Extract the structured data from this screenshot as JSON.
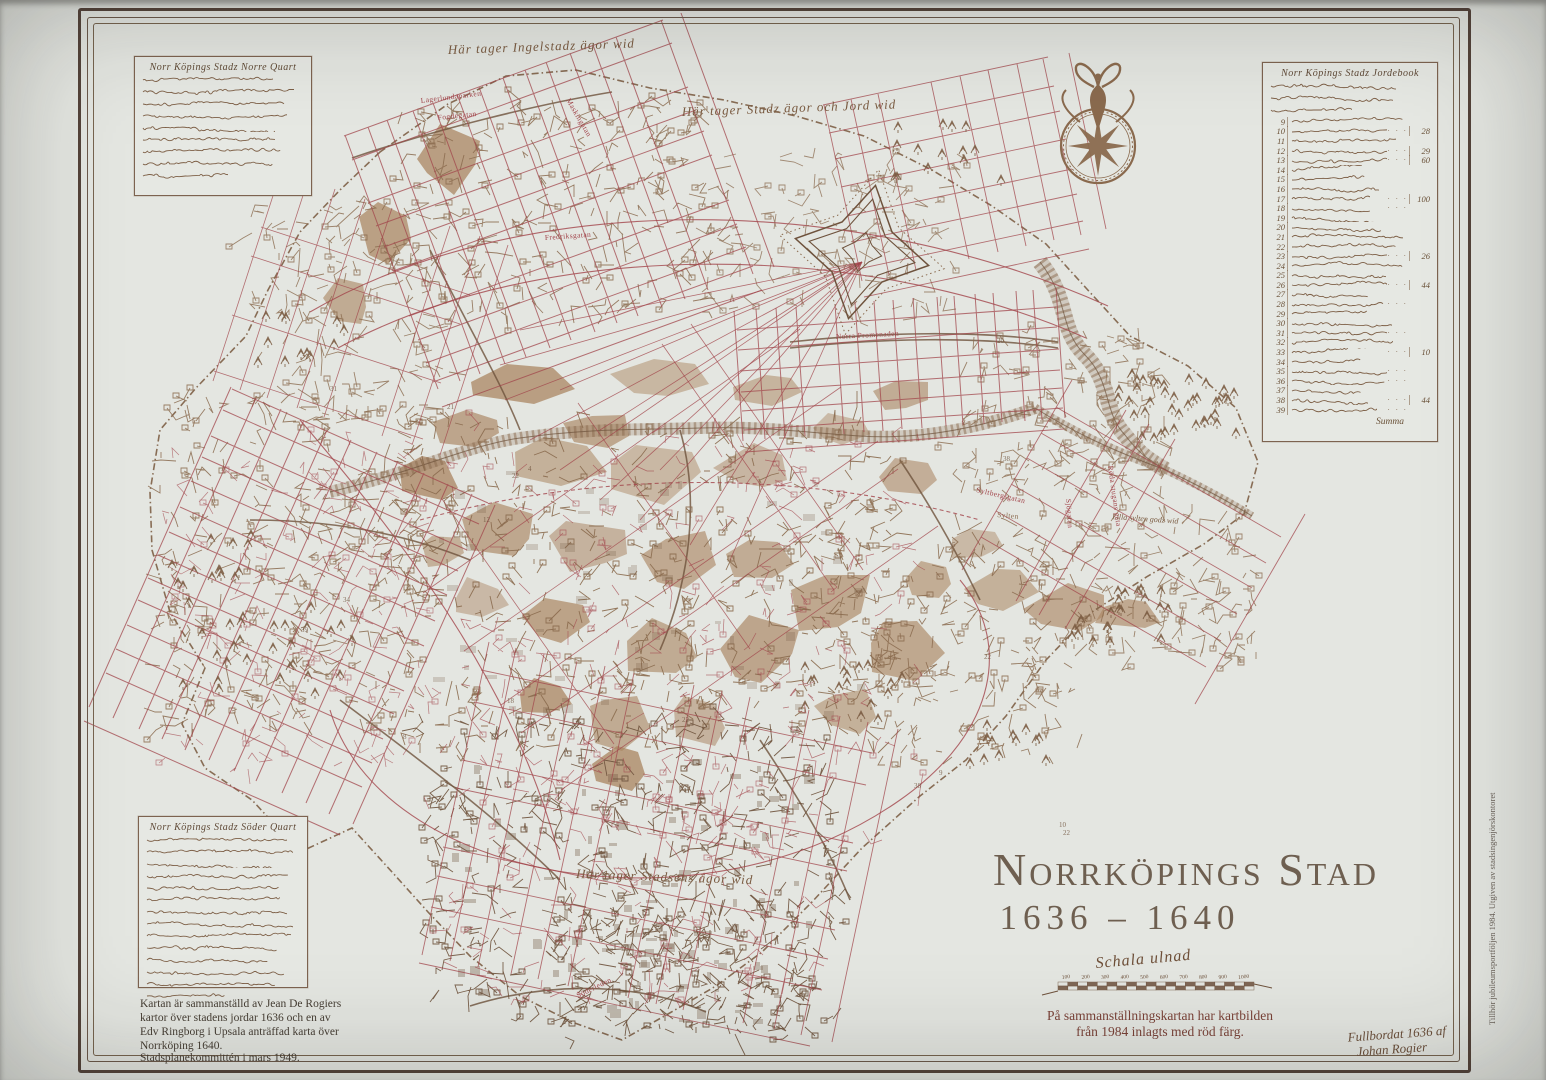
{
  "poster": {
    "title": "Norrköpings Stad",
    "years": "1636 – 1640",
    "side_note": "Tillhör jubileumsportföljen 1984. Utgiven av stadsingenjörskontoret",
    "signature_line1": "Fullbordat 1636 af",
    "signature_line2": "Johan Rogier"
  },
  "scale": {
    "caption": "Schala ulnad",
    "ticks": [
      "100",
      "200",
      "300",
      "400",
      "500",
      "600",
      "700",
      "800",
      "900",
      "1000"
    ]
  },
  "overlay_note": {
    "line1": "På sammanställningskartan har kartbilden",
    "line2": "från 1984 inlagts med röd färg."
  },
  "credits": {
    "line1": "Kartan är sammanställd av Jean De Rogiers",
    "line2": "kartor över stadens jordar 1636 och en av",
    "line3": "Edv Ringborg i Upsala anträffad karta över",
    "line4": "Norrköping 1640.",
    "committee": "Stadsplanekommittén i mars 1949."
  },
  "cartouche_top": {
    "title": "Norr Köpings Stadz Norre Quart",
    "lines": 9
  },
  "cartouche_bottom": {
    "title": "Norr Köpings Stadz Söder Quart",
    "lines": 14
  },
  "legend": {
    "title": "Norr Köpings Stadz Jordebook",
    "first_no": 9,
    "last_no": 39,
    "values": {
      "10": "28",
      "12": "29",
      "13": "60",
      "17": "100",
      "23": "26",
      "26": "44",
      "33": "10",
      "38": "44"
    },
    "summa_label": "Summa"
  },
  "map": {
    "labels": {
      "lagerlundaparken": "Lagerlundaparken",
      "fogdegatan": "Fogdegatan",
      "maskingatan": "Maskingatan",
      "fredriksgatan": "Fredriksgatan",
      "norra_promenaden": "Norra Promenaden",
      "syltbergsgatan": "Syltbergsgatan",
      "sylten": "Sylten",
      "sjogatan": "Sjögatan",
      "roda_stugans_gata": "Röda stugans gata",
      "soderleden": "Söderleden"
    },
    "annotations": {
      "north1": "Här tager Ingelstadz ägor wid",
      "north2": "Här tager Stadz ägor och Jord wid",
      "south1": "Här tager Stadsens ägor wid",
      "sylten_note": "Lilla sylten godz wid"
    }
  },
  "colors": {
    "paper": "#e3e5e0",
    "brown": "#8a6a4e",
    "dark_brown": "#6e523c",
    "red": "#a2454b",
    "tan": "#a9835f",
    "frame": "#54433a",
    "ink": "#3e362e"
  }
}
